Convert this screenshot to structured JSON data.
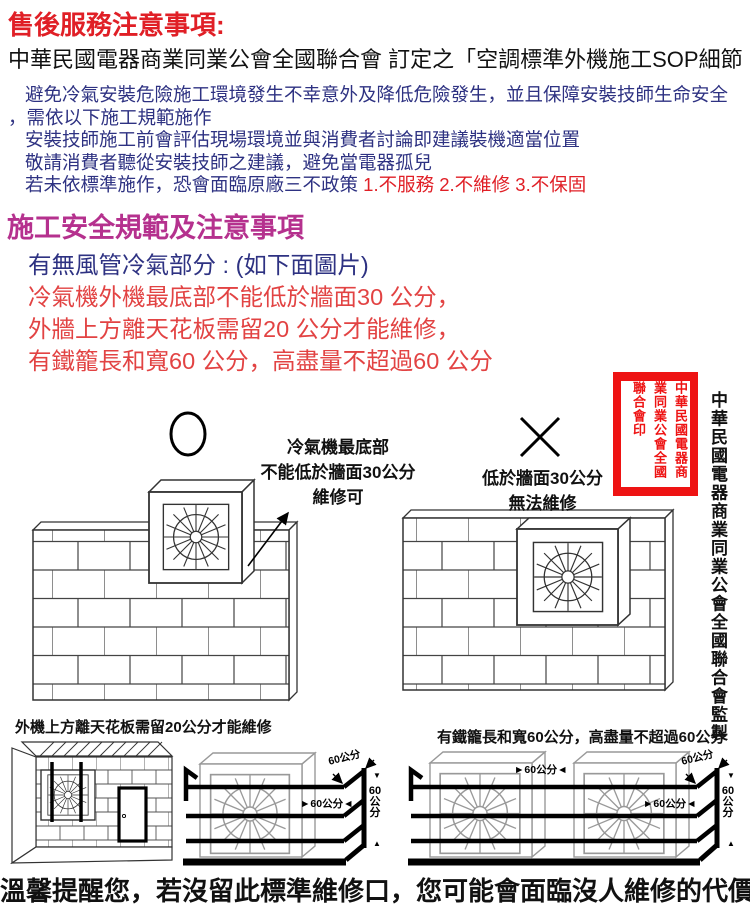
{
  "colors": {
    "title_red": "#e01f26",
    "body_navy": "#2e3282",
    "rule_red": "#e24343",
    "heading_magenta": "#b5318e",
    "stamp_red": "#ee1313",
    "ink": "#111111"
  },
  "header": {
    "title": "售後服務注意事項:",
    "subtitle": "中華民國電器商業同業公會全國聯合會 訂定之「空調標準外機施工SOP細節",
    "intro_lines": [
      "避免冷氣安裝危險施工環境發生不幸意外及降低危險發生，並且保障安裝技師生命安全",
      "，需依以下施工規範施作",
      "安裝技師施工前會評估現場環境並與消費者討論即建議裝機適當位置",
      "敬請消費者聽從安裝技師之建議，避免當電器孤兒"
    ],
    "policy_prefix": "若未依標準施作，恐會面臨原廠三不政策 ",
    "policy_red": "1.不服務 2.不維修 3.不保固"
  },
  "section": {
    "heading": "施工安全規範及注意事項",
    "subheading": "有無風管冷氣部分 : (如下面圖片)",
    "rules": [
      "冷氣機外機最底部不能低於牆面30 公分，",
      "外牆上方離天花板需留20 公分才能維修，",
      "有鐵籠長和寬60 公分，高盡量不超過60 公分"
    ]
  },
  "diagrams": {
    "good": {
      "caption1": "冷氣機最底部",
      "caption2": "不能低於牆面30公分",
      "caption3": "維修可"
    },
    "bad": {
      "caption1": "低於牆面30公分",
      "caption2": "無法維修"
    },
    "ceiling_caption": "外機上方離天花板需留20公分才能維修",
    "cage_caption": "有鐵籠長和寬60公分，高盡量不超過60公分",
    "dim": "60公分",
    "arrow_right": "►",
    "arrow_left": "◄",
    "arrow_down": "▼",
    "arrow_up": "▲"
  },
  "stamp": {
    "seal_text": "中華民國電器商業同業公會全國聯合會印"
  },
  "side_caption": "中華民國電器商業同業公會全國聯合會監製",
  "footer": "溫馨提醒您，若沒留此標準維修口，您可能會面臨沒人維修的代價"
}
